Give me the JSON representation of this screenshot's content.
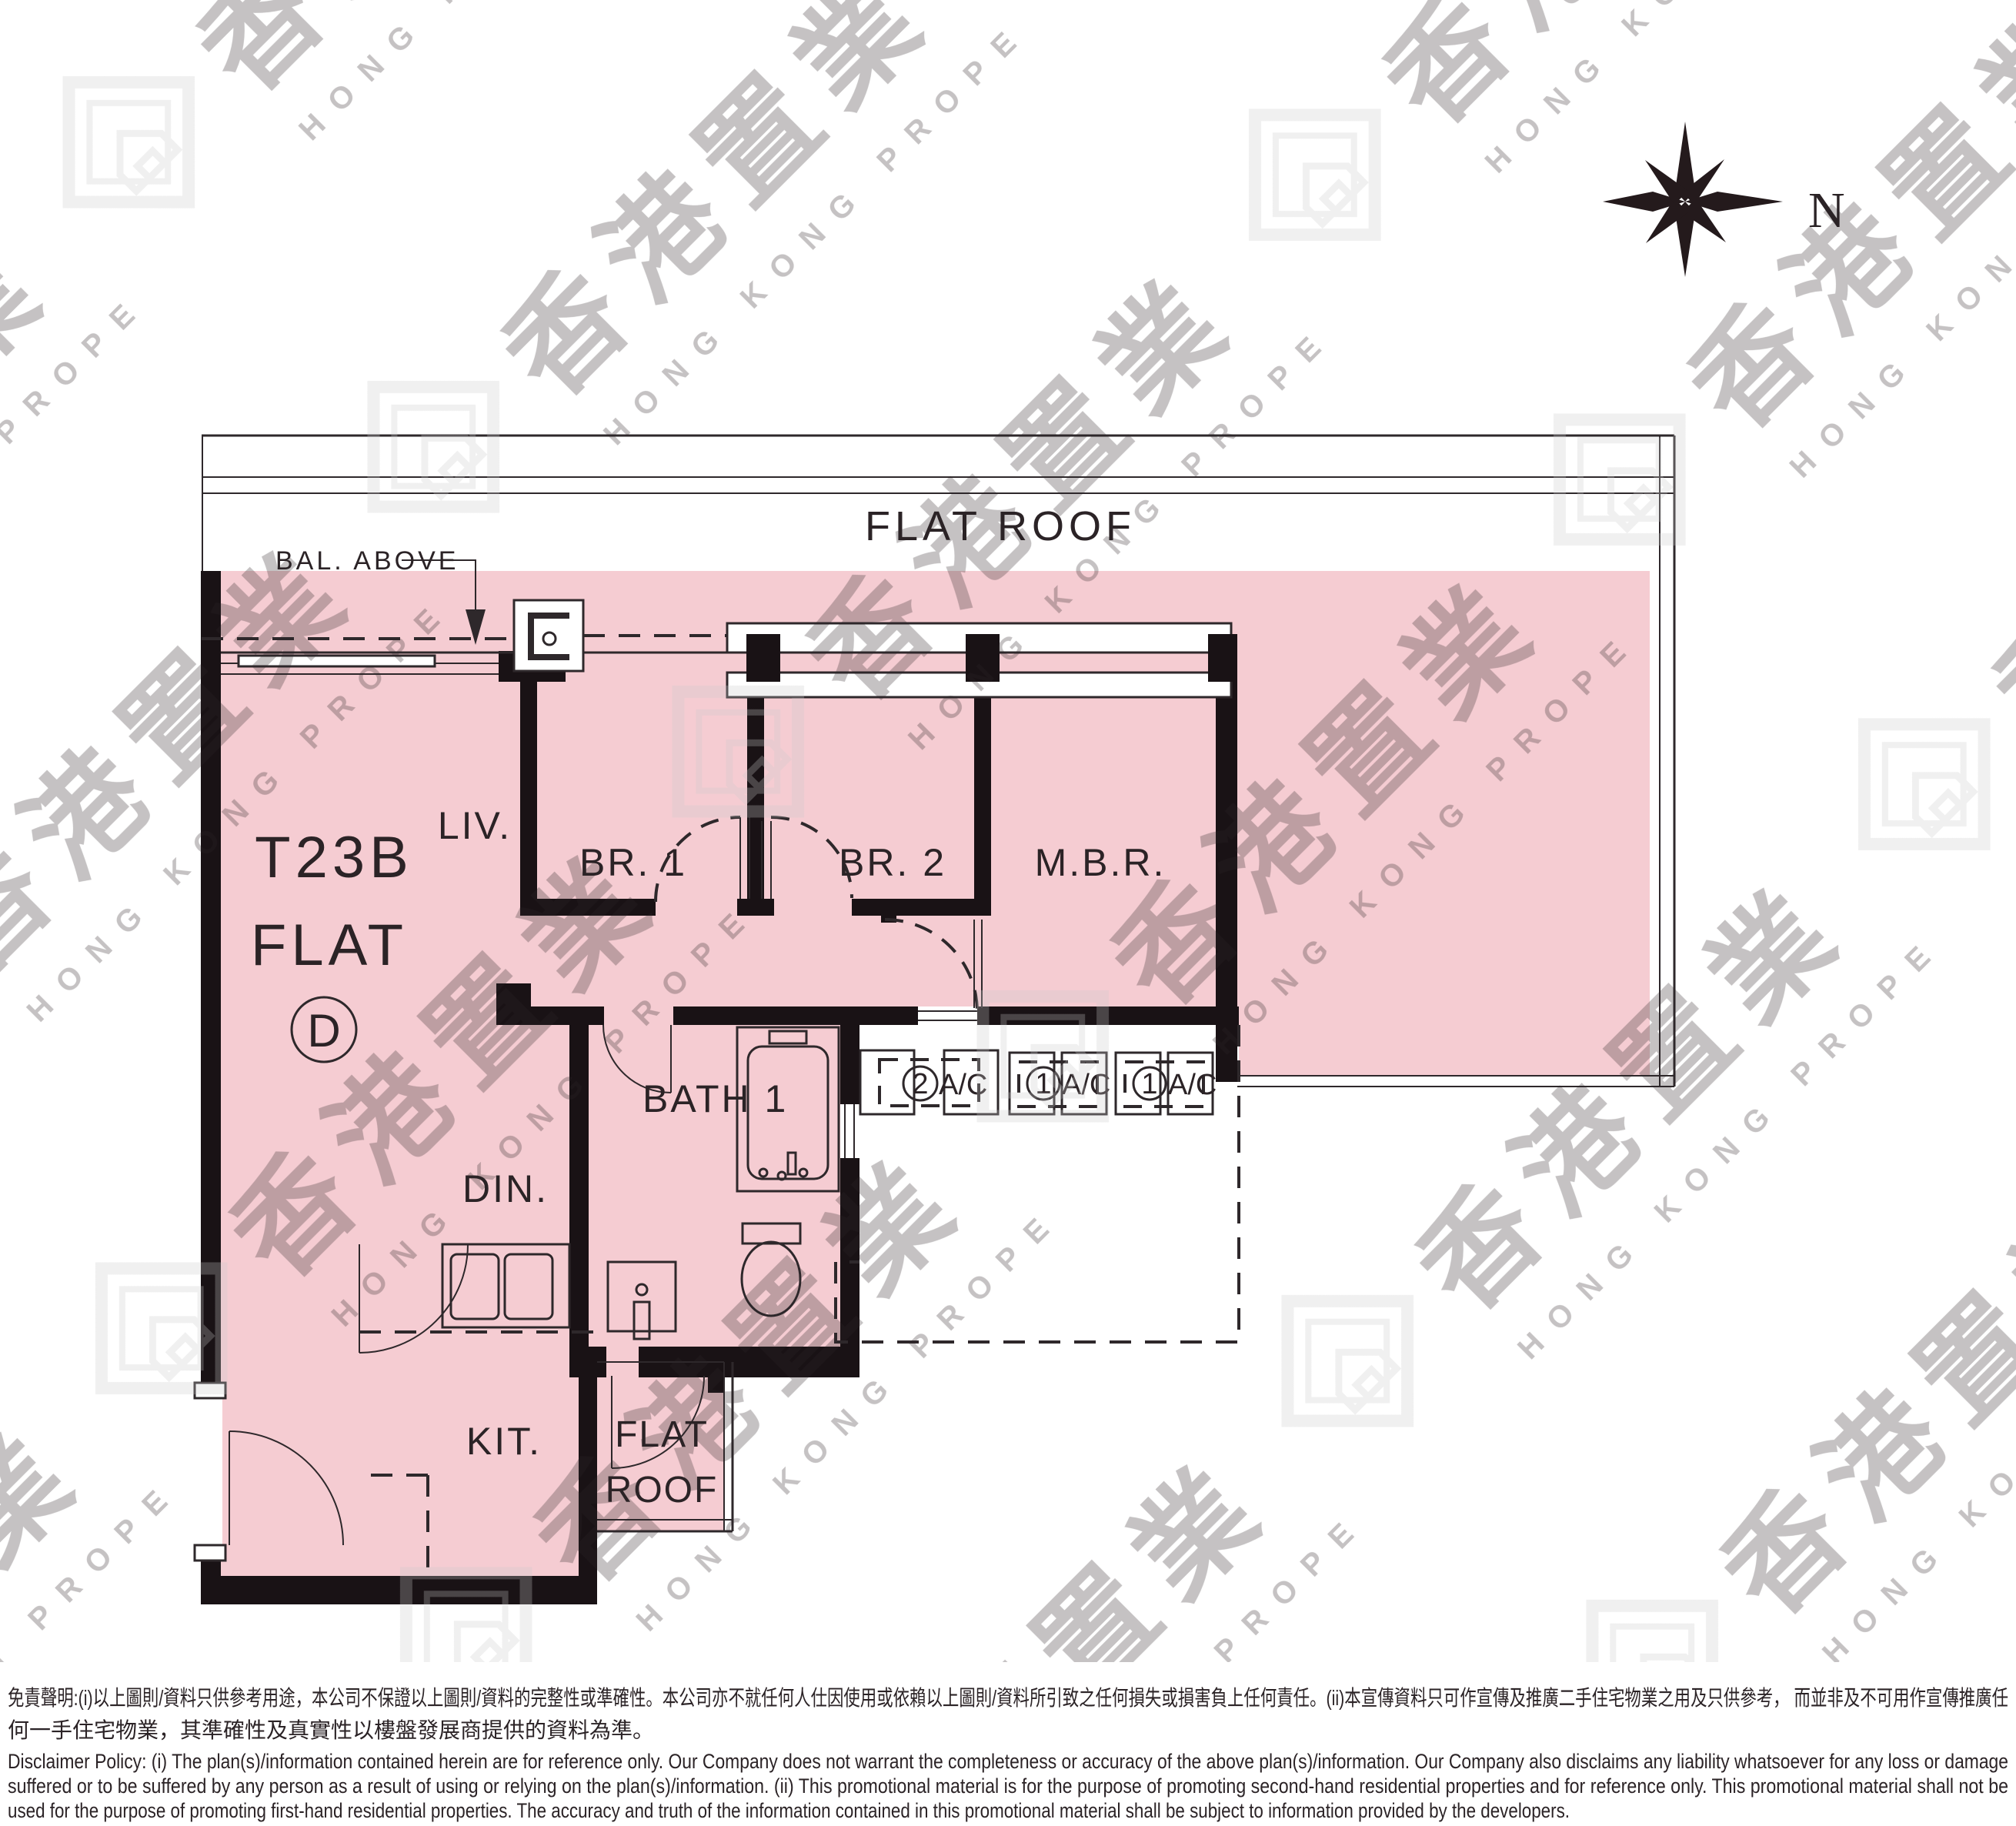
{
  "watermark": {
    "cn": "香港置業",
    "en": "HONG KONG PROPERTY"
  },
  "compass": {
    "label": "N"
  },
  "plan": {
    "bal_above": "BAL. ABOVE",
    "flat_roof_main": "FLAT ROOF",
    "unit": {
      "tower": "T23B",
      "flat_word": "FLAT",
      "flat_letter": "D"
    },
    "rooms": {
      "living": "LIV.",
      "bedroom1": "BR. 1",
      "bedroom2": "BR. 2",
      "master": "M.B.R.",
      "dining": "DIN.",
      "bath": "BATH 1",
      "kitchen": "KIT.",
      "flat_roof_small_line1": "FLAT",
      "flat_roof_small_line2": "ROOF"
    },
    "ac_units": [
      {
        "num": "2",
        "label": "A/C"
      },
      {
        "num": "1",
        "label": "A/C"
      },
      {
        "num": "1",
        "label": "A/C"
      }
    ]
  },
  "disclaimer": {
    "zh_line1": "免責聲明:(i)以上圖則/資料只供參考用途，本公司不保證以上圖則/資料的完整性或準確性。本公司亦不就任何人仕因使用或依賴以上圖則/資料所引致之任何損失或損害負上任何責任。(ii)本宣傳資料只可作宣傳及推廣二手住宅物業之用及只供參考， 而並非及不可用作宣傳推廣任",
    "zh_line2": "何一手住宅物業，其準確性及真實性以樓盤發展商提供的資料為準。",
    "en_line1": "Disclaimer Policy: (i) The plan(s)/information contained herein are for reference only. Our Company does not warrant the completeness or accuracy of the above plan(s)/information. Our Company also disclaims any liability whatsoever for any loss or damage",
    "en_line2": "suffered or to be suffered by any person as a result of using or relying on the plan(s)/information. (ii) This promotional material is for the purpose of promoting second-hand residential properties and for reference only. This promotional material shall not be",
    "en_line3": "used for the purpose of promoting first-hand residential properties. The accuracy and truth of the information contained in this promotional material shall be subject to information provided by the developers."
  },
  "colors": {
    "floor_pink": "#f5ccd2",
    "wall": "#191215",
    "line": "#2e282b",
    "watermark": "#c9c9c9"
  }
}
